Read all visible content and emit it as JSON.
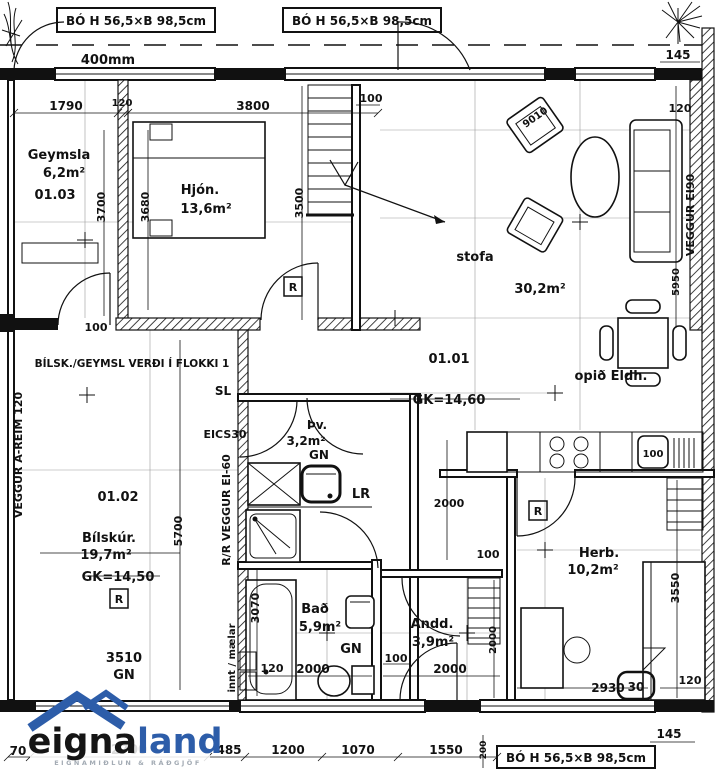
{
  "drawing_title": "floor-plan",
  "window_labels": {
    "top_1": "BÓ H 56,5×B 98,5cm",
    "top_2": "BÓ H 56,5×B 98,5cm",
    "bottom": "BÓ H 56,5×B 98,5cm"
  },
  "notes": {
    "wall_thickness": "400mm",
    "garage_note": "BÍLSK./GEYMSL VERÐI Í FLOKKI 1",
    "sl": "SL",
    "eics": "EICS30",
    "lr": "LR",
    "radiator": "R",
    "gn": "GN",
    "innt": "innt / mælar",
    "wall_right": "VEGGUR EI90",
    "wall_left": "VEGGUR A-REIM 120",
    "wall_center": "R/R VEGGUR EI-60"
  },
  "rooms": {
    "geymsla": {
      "name": "Geymsla",
      "area": "6,2m²",
      "id": "01.03"
    },
    "hjon": {
      "name": "Hjón.",
      "area": "13,6m²"
    },
    "stofa": {
      "name": "stofa",
      "area": "30,2m²",
      "id": "01.01",
      "level": "GK=14,60"
    },
    "eldhus": {
      "name": "opið Eldh."
    },
    "bilskur": {
      "name": "Bílskúr.",
      "area": "19,7m²",
      "id": "01.02",
      "level": "GK=14,50"
    },
    "thvottur": {
      "name": "Þv.",
      "area": "3,2m²"
    },
    "bad": {
      "name": "Bað",
      "area": "5,9m²"
    },
    "anddyri": {
      "name": "Andd.",
      "area": "3,9m²"
    },
    "herbergi": {
      "name": "Herb.",
      "area": "10,2m²"
    }
  },
  "dims": {
    "v30": "30",
    "v70": "70",
    "v100": "100",
    "v120": "120",
    "v145": "145",
    "v200": "200",
    "v485": "485",
    "v1070": "1070",
    "v1200": "1200",
    "v1550": "1550",
    "v1790": "1790",
    "v2000": "2000",
    "v2700": "2700",
    "v2930": "2930",
    "v3070": "3070",
    "v3500": "3500",
    "v3510": "3510",
    "v3550": "3550",
    "v3680": "3680",
    "v3700": "3700",
    "v3800": "3800",
    "v5700": "5700",
    "v5950": "5950",
    "v9010": "9010"
  },
  "logo": {
    "name_dark": "eigna",
    "name_blue": "land",
    "tagline": "EIGNAMIÐLUN & RÁÐGJÖF",
    "blue": "#2d5da9",
    "dark": "#151515",
    "gray": "#a3abb4"
  }
}
